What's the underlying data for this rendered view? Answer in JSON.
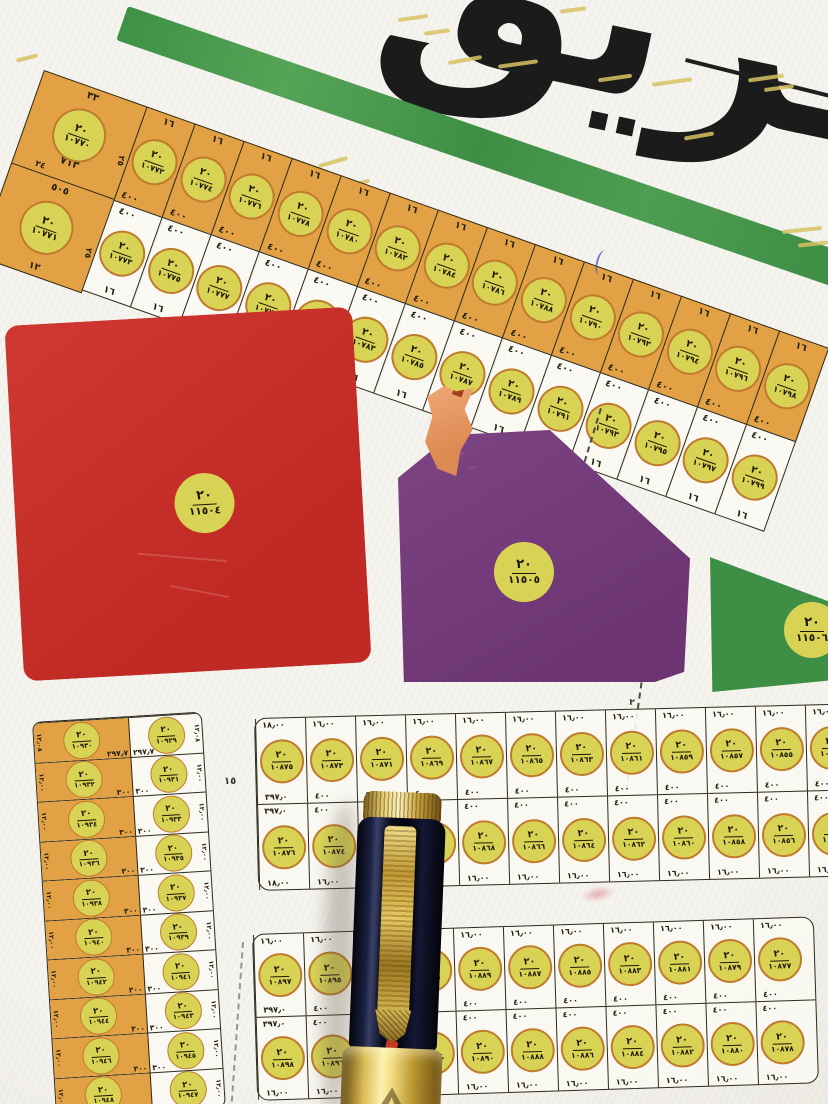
{
  "street_name": "طريق",
  "block_label": "٢٠",
  "strip": {
    "dim": "١٦",
    "area": "٤٠٠",
    "big": [
      {
        "num": "١٠٧٧٠",
        "top": "٣٣",
        "area": "٧١٣",
        "side": "٢٤",
        "edge": "٢٥"
      },
      {
        "num": "١٠٧٧١",
        "top": "٥٠٥",
        "bottom": "١٢",
        "edge": "٢٥"
      }
    ],
    "cols": [
      {
        "tn": "١٠٧٧٢",
        "bn": "١٠٧٧٣"
      },
      {
        "tn": "١٠٧٧٤",
        "bn": "١٠٧٧٥"
      },
      {
        "tn": "١٠٧٧٦",
        "bn": "١٠٧٧٧"
      },
      {
        "tn": "١٠٧٧٨",
        "bn": "١٠٧٧٩"
      },
      {
        "tn": "١٠٧٨٠",
        "bn": "١٠٧٨١"
      },
      {
        "tn": "١٠٧٨٢",
        "bn": "١٠٧٨٣"
      },
      {
        "tn": "١٠٧٨٤",
        "bn": "١٠٧٨٥"
      },
      {
        "tn": "١٠٧٨٦",
        "bn": "١٠٧٨٧"
      },
      {
        "tn": "١٠٧٨٨",
        "bn": "١٠٧٨٩"
      },
      {
        "tn": "١٠٧٩٠",
        "bn": "١٠٧٩١"
      },
      {
        "tn": "١٠٧٩٢",
        "bn": "١٠٧٩٣"
      },
      {
        "tn": "١٠٧٩٤",
        "bn": "١٠٧٩٥"
      },
      {
        "tn": "١٠٧٩٦",
        "bn": "١٠٧٩٧"
      },
      {
        "tn": "١٠٧٩٨",
        "bn": "١٠٧٩٩"
      }
    ]
  },
  "parcels": {
    "red": {
      "num": "١١٥٠٤"
    },
    "purple": {
      "num": "١١٥٠٥"
    },
    "green": {
      "num": "١١٥٠٦"
    }
  },
  "left_block": {
    "rows": [
      {
        "on": "١٠٩٣٠",
        "wn": "١٠٩٢٩",
        "ao": "٢٩٧٫٧",
        "aw": "٢٩٧٫٧",
        "sl": "١٢٫٠٨",
        "sr": "١٢٫٠٨"
      },
      {
        "on": "١٠٩٣٢",
        "wn": "١٠٩٣١",
        "ao": "٣٠٠",
        "aw": "٣٠٠",
        "sl": "١٢٫٠٠",
        "sr": "١٢٫٠٠"
      },
      {
        "on": "١٠٩٣٤",
        "wn": "١٠٩٣٣",
        "ao": "٣٠٠",
        "aw": "٣٠٠",
        "sl": "١٢٫٠٠",
        "sr": "١٢٫٠٠"
      },
      {
        "on": "١٠٩٣٦",
        "wn": "١٠٩٣٥",
        "ao": "٣٠٠",
        "aw": "٣٠٠",
        "sl": "١٢٫٠٠",
        "sr": "١٢٫٠٠"
      },
      {
        "on": "١٠٩٣٨",
        "wn": "١٠٩٣٧",
        "ao": "٣٠٠",
        "aw": "٣٠٠",
        "sl": "١٢٫٠٠",
        "sr": "١٢٫٠٠"
      },
      {
        "on": "١٠٩٤٠",
        "wn": "١٠٩٣٩",
        "ao": "٣٠٠",
        "aw": "٣٠٠",
        "sl": "١٢٫٠٠",
        "sr": "١٢٫٠٠"
      },
      {
        "on": "١٠٩٤٢",
        "wn": "١٠٩٤١",
        "ao": "٣٠٠",
        "aw": "٣٠٠",
        "sl": "١٢٫٠٠",
        "sr": "١٢٫٠٠"
      },
      {
        "on": "١٠٩٤٤",
        "wn": "١٠٩٤٣",
        "ao": "٣٠٠",
        "aw": "٣٠٠",
        "sl": "١٢٫٠٠",
        "sr": "١٢٫٠٠"
      },
      {
        "on": "١٠٩٤٦",
        "wn": "١٠٩٤٥",
        "ao": "٣٠٠",
        "aw": "٣٠٠",
        "sl": "١٢٫٠٠",
        "sr": "١٢٫٠٠"
      },
      {
        "on": "١٠٩٤٨",
        "wn": "١٠٩٤٧",
        "ao": "٣٠٠",
        "aw": "٣٠٠",
        "sl": "١٢٫٠٠",
        "sr": "١٢٫٠٠"
      }
    ]
  },
  "grid1": {
    "r1": [
      {
        "n": "١٠٨٧٥",
        "t": "١٨٫٠٠",
        "a": "٣٩٧٫٠"
      },
      {
        "n": "١٠٨٧٣",
        "t": "١٦٫٠٠",
        "a": "٤٠٠"
      },
      {
        "n": "١٠٨٧١",
        "t": "١٦٫٠٠",
        "a": "٤٠٠"
      },
      {
        "n": "١٠٨٦٩",
        "t": "١٦٫٠٠",
        "a": "٤٠٠"
      },
      {
        "n": "١٠٨٦٧",
        "t": "١٦٫٠٠",
        "a": "٤٠٠"
      },
      {
        "n": "١٠٨٦٥",
        "t": "١٦٫٠٠",
        "a": "٤٠٠"
      },
      {
        "n": "١٠٨٦٣",
        "t": "١٦٫٠٠",
        "a": "٤٠٠"
      },
      {
        "n": "١٠٨٦١",
        "t": "١٦٫٠٠",
        "a": "٤٠٠"
      },
      {
        "n": "١٠٨٥٩",
        "t": "١٦٫٠٠",
        "a": "٤٠٠"
      },
      {
        "n": "١٠٨٥٧",
        "t": "١٦٫٠٠",
        "a": "٤٠٠"
      },
      {
        "n": "١٠٨٥٥",
        "t": "١٦٫٠٠",
        "a": "٤٠٠"
      },
      {
        "n": "١٠٨٥٣",
        "t": "١٦٫٠٠",
        "a": "٤٠٠"
      }
    ],
    "r2": [
      {
        "n": "١٠٨٧٦",
        "t": "٣٩٧٫٠",
        "a": "١٨٫٠٠"
      },
      {
        "n": "١٠٨٧٤",
        "t": "٤٠٠",
        "a": "١٦٫٠٠"
      },
      {
        "n": "١٠٨٧٢",
        "t": "٤٠٠",
        "a": "١٦٫٠٠"
      },
      {
        "n": "١٠٨٧٠",
        "t": "٤٠٠",
        "a": "١٦٫٠٠"
      },
      {
        "n": "١٠٨٦٨",
        "t": "٤٠٠",
        "a": "١٦٫٠٠"
      },
      {
        "n": "١٠٨٦٦",
        "t": "٤٠٠",
        "a": "١٦٫٠٠"
      },
      {
        "n": "١٠٨٦٤",
        "t": "٤٠٠",
        "a": "١٦٫٠٠"
      },
      {
        "n": "١٠٨٦٢",
        "t": "٤٠٠",
        "a": "١٦٫٠٠"
      },
      {
        "n": "١٠٨٦٠",
        "t": "٤٠٠",
        "a": "١٦٫٠٠"
      },
      {
        "n": "١٠٨٥٨",
        "t": "٤٠٠",
        "a": "١٦٫٠٠"
      },
      {
        "n": "١٠٨٥٦",
        "t": "٤٠٠",
        "a": "١٦٫٠٠"
      },
      {
        "n": "١٠٨٥٤",
        "t": "٤٠٠",
        "a": "١٦٫٠٠"
      }
    ]
  },
  "grid2": {
    "r1": [
      {
        "n": "١٠٨٩٧",
        "t": "١٦٫٠٠",
        "a": "٣٩٧٫٠"
      },
      {
        "n": "١٠٨٩٥",
        "t": "١٦٫٠٠",
        "a": "٤٠٠"
      },
      {
        "n": "١٠٨٩٣",
        "t": "١٦٫٠٠",
        "a": "٤٠٠"
      },
      {
        "n": "١٠٨٩١",
        "t": "١٦٫٠٠",
        "a": "٤٠٠"
      },
      {
        "n": "١٠٨٨٩",
        "t": "١٦٫٠٠",
        "a": "٤٠٠"
      },
      {
        "n": "١٠٨٨٧",
        "t": "١٦٫٠٠",
        "a": "٤٠٠"
      },
      {
        "n": "١٠٨٨٥",
        "t": "١٦٫٠٠",
        "a": "٤٠٠"
      },
      {
        "n": "١٠٨٨٣",
        "t": "١٦٫٠٠",
        "a": "٤٠٠"
      },
      {
        "n": "١٠٨٨١",
        "t": "١٦٫٠٠",
        "a": "٤٠٠"
      },
      {
        "n": "١٠٨٧٩",
        "t": "١٦٫٠٠",
        "a": "٤٠٠"
      },
      {
        "n": "١٠٨٧٧",
        "t": "١٦٫٠٠",
        "a": "٤٠٠"
      }
    ],
    "r2": [
      {
        "n": "١٠٨٩٨",
        "t": "٣٩٧٫٠",
        "a": "١٦٫٠٠"
      },
      {
        "n": "١٠٨٩٦",
        "t": "٤٠٠",
        "a": "١٦٫٠٠"
      },
      {
        "n": "١٠٨٩٤",
        "t": "٤٠٠",
        "a": "١٦٫٠٠"
      },
      {
        "n": "١٠٨٩٢",
        "t": "٤٠٠",
        "a": "١٦٫٠٠"
      },
      {
        "n": "١٠٨٩٠",
        "t": "٤٠٠",
        "a": "١٦٫٠٠"
      },
      {
        "n": "١٠٨٨٨",
        "t": "٤٠٠",
        "a": "١٦٫٠٠"
      },
      {
        "n": "١٠٨٨٦",
        "t": "٤٠٠",
        "a": "١٦٫٠٠"
      },
      {
        "n": "١٠٨٨٤",
        "t": "٤٠٠",
        "a": "١٦٫٠٠"
      },
      {
        "n": "١٠٨٨٢",
        "t": "٤٠٠",
        "a": "١٦٫٠٠"
      },
      {
        "n": "١٠٨٨٠",
        "t": "٤٠٠",
        "a": "١٦٫٠٠"
      },
      {
        "n": "١٠٨٧٨",
        "t": "٤٠٠",
        "a": "١٦٫٠٠"
      }
    ]
  },
  "street_labels": {
    "width15": "١٥",
    "centerline": "٢"
  }
}
